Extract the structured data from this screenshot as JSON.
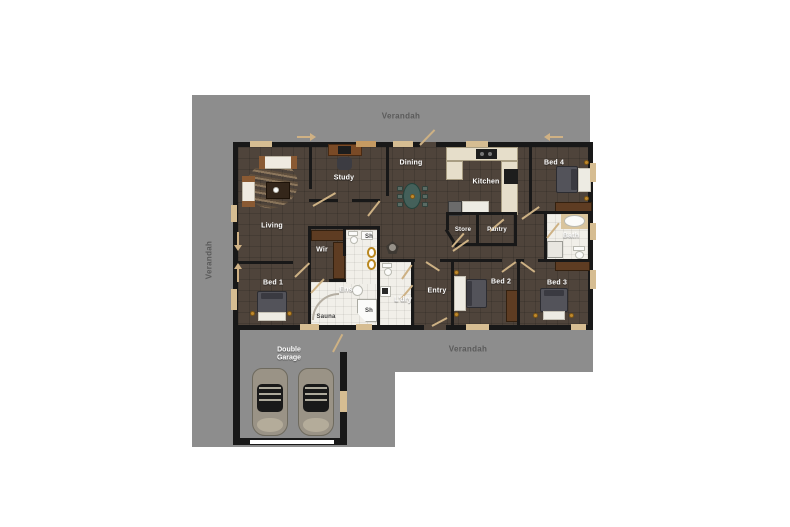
{
  "verandah_labels": {
    "top": "Verandah",
    "left": "Verandah",
    "bottom": "Verandah"
  },
  "rooms": {
    "living": "Living",
    "study": "Study",
    "dining": "Dining",
    "kitchen": "Kitchen",
    "bed1": "Bed 1",
    "bed2": "Bed 2",
    "bed3": "Bed 3",
    "bed4": "Bed 4",
    "bath": "Bath",
    "wir": "Wir",
    "ens": "Ens",
    "laundry": "L'dry",
    "entry": "Entry",
    "store": "Store",
    "pantry": "Pantry",
    "sauna": "Sauna",
    "shower_top": "Sh",
    "shower_corner": "Sh",
    "garage": "Double Garage"
  },
  "colors": {
    "background": "#ffffff",
    "verandah": "#8d8d8d",
    "verandah_text": "#5a5a5a",
    "house_floor": "#4f443b",
    "walls": "#181818",
    "wet_area_tile": "#f1efe9",
    "kitchen_bench": "#e6deca",
    "door_swing": "#cdb184",
    "window": "#d6bd92",
    "room_text": "#ffffff",
    "timber": "#5e3c22",
    "gold_fitting": "#c08a2e",
    "car_body": "#9a9386"
  }
}
